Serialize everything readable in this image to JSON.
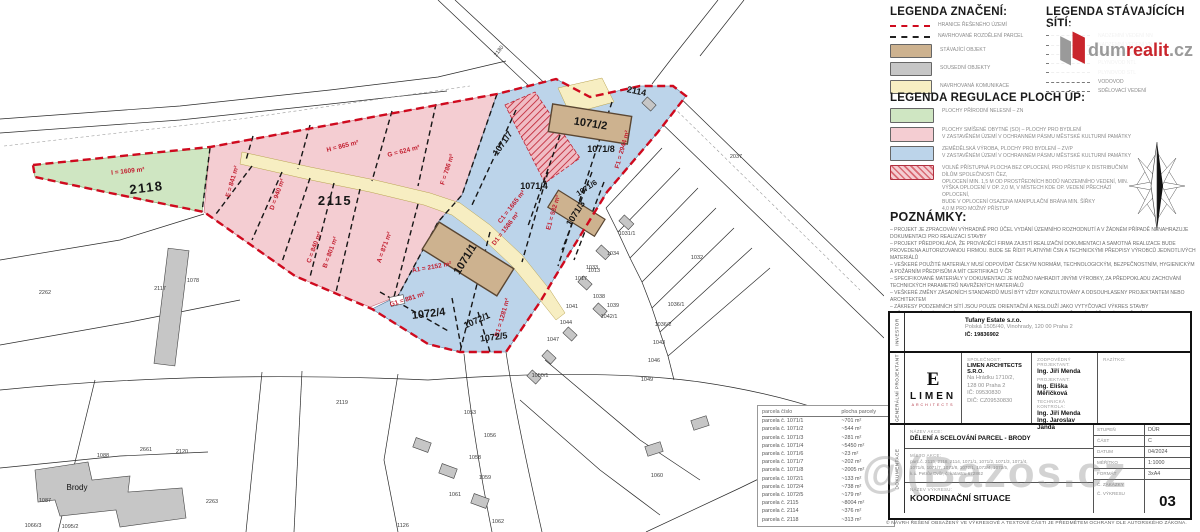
{
  "legend_znaceni": {
    "title": "LEGENDA ZNAČENÍ:",
    "items": [
      {
        "kind": "line",
        "color": "#cf0a1e",
        "label": "HRANICE ŘEŠENÉHO ÚZEMÍ"
      },
      {
        "kind": "line",
        "color": "#222222",
        "label": "NAVRHOVANÉ ROZDĚLENÍ PARCEL"
      },
      {
        "kind": "swatch",
        "color": "#cdb28f",
        "label": "STÁVAJÍCÍ OBJEKT"
      },
      {
        "kind": "swatch",
        "color": "#c6c6c6",
        "label": "SOUSEDNÍ OBJEKTY"
      },
      {
        "kind": "swatch",
        "color": "#f7eec2",
        "label": "NAVRHOVANÁ KOMUNIKACE"
      }
    ]
  },
  "legend_site": {
    "title": "LEGENDA STÁVAJÍCÍCH SÍTÍ:",
    "items": [
      "NADZEMNÍ VEDENÍ NN",
      "NADZEMNÍ VEDENÍ VN",
      "SPLAŠKOVÁ KANALIZACE",
      "PLYNOVOD NTL",
      "PLYNOVOD STL",
      "VODOVOD",
      "SDĚLOVACÍ VEDENÍ"
    ]
  },
  "legend_regulace": {
    "title": "LEGENDA REGULACE PLOCH ÚP:",
    "items": [
      {
        "kind": "swatch",
        "color": "#cfe6c2",
        "label": "PLOCHY PŘÍRODNÍ NELESNÍ – ZN"
      },
      {
        "kind": "swatch",
        "color": "#f4cdd2",
        "label": "PLOCHY SMÍŠENÉ OBYTNÉ (SO) – PLOCHY PRO BYDLENÍ\nV ZASTAVĚNÉM ÚZEMÍ V OCHRANNÉM PÁSMU MĚSTSKÉ KULTURNÍ PAMÁTKY"
      },
      {
        "kind": "swatch",
        "color": "#bcd4ea",
        "label": "ZEMĚDĚLSKÁ VÝROBA, PLOCHY PRO BYDLENÍ – ZV/P\nV ZASTAVĚNÉM ÚZEMÍ V OCHRANNÉM PÁSMU MĚSTSKÉ KULTURNÍ PAMÁTKY"
      },
      {
        "kind": "hatch",
        "color": "#f4cdd2",
        "label": "VOLNĚ PŘÍSTUPNÁ PLOCHA BEZ OPLOCENÍ, PRO PŘÍSTUP K DISTRIBUČNÍM\nDÍLŮM SPOLEČNOSTI ČEZ,\nOPLOCENÍ MIN. 1,5 m OD PROSTŘEDNÍCH BODŮ NADZEMNÍHO VEDENÍ, MIN.\nVÝŠKA OPLOCENÍ V OP. 2,0 m, V MÍSTECH KDE OP. VEDENÍ PŘECHÁZÍ OPLOCENÍ,\nBUDE V OPLOCENÍ OSAZENA MANIPULAČNÍ BRÁNA MIN. ŠÍŘKY\n4,0 m PRO MOŽNÝ PŘÍSTUP"
      }
    ]
  },
  "poznamky": {
    "title": "POZNÁMKY:",
    "lines": [
      "PROJEKT JE ZPRACOVÁN VÝHRADNĚ PRO ÚČEL VYDÁNÍ ÚZEMNÍHO ROZHODNUTÍ A V ŽÁDNÉM PŘÍPADĚ NENAHRAZUJE DOKUMENTACI PRO REALIZACI STAVBY",
      "PROJEKT PŘEDPOKLÁDÁ, ŽE PROVÁDĚCÍ FIRMA ZAJISTÍ REALIZAČNÍ DOKUMENTACI A SAMOTNÁ REALIZACE BUDE PROVEDENA AUTORIZOVANOU FIRMOU. BUDE SE ŘÍDIT PLATNÝMI ČSN A TECHNICKÝMI PŘEDPISY VÝROBCŮ JEDNOTLIVÝCH MATERIÁLŮ",
      "VEŠKERÉ POUŽITÉ MATERIÁLY MUSÍ ODPOVÍDAT ČESKÝM NORMÁM, TECHNOLOGICKÝM, BEZPEČNOSTNÍM, HYGIENICKÝM A POŽÁRNÍM PŘEDPISŮM A MÍT CERTIFIKACI V ČR",
      "SPECIFIKOVANÉ MATERIÁLY V DOKUMENTACI JE MOŽNO NAHRADIT JINÝMI VÝROBKY, ZA PŘEDPOKLADU ZACHOVÁNÍ TECHNICKÝCH PARAMETRŮ NAVRŽENÝCH MATERIÁLŮ",
      "VEŠKERÉ ZMĚNY ZÁSADNÍCH STANDARDŮ MUSÍ BÝT VŽDY KONZULTOVÁNY A ODSOUHLASENY PROJEKTANTEM NEBO ARCHITEKTEM",
      "ZÁKRESY PODZEMNÍCH SÍTÍ JSOU POUZE ORIENTAČNÍ A NESLOUŽÍ JAKO VYTYČOVACÍ VÝKRES STAVBY",
      "PŘED ZAHÁJENÍM ZEMNÍCH PRACÍ PROVEDOU SPRÁVCI SÍTÍ JEJICH SMĚROVÉ I VÝŠKOVÉ VYTYČENÍ",
      "BUDE DODRŽENA ČSN 73 6005 PROSTOROVÉ USPOŘÁDÁNÍ SÍTÍ TECH. VYBAVENÍ",
      "BUDOU DODRŽENY PODMÍNKY VŠECH SPRÁVCŮ SÍTÍ VIZ DOKLADOVÁ ČÁST PD"
    ]
  },
  "parcel_table": {
    "headers": [
      "parcela číslo",
      "plocha parcely"
    ],
    "rows": [
      [
        "parcela č. 1071/1",
        "~701 m²"
      ],
      [
        "parcela č. 1071/2",
        "~544 m²"
      ],
      [
        "parcela č. 1071/3",
        "~281 m²"
      ],
      [
        "parcela č. 1071/4",
        "~5450 m²"
      ],
      [
        "parcela č. 1071/6",
        "~23 m²"
      ],
      [
        "parcela č. 1071/7",
        "~202 m²"
      ],
      [
        "parcela č. 1071/8",
        "~2005 m²"
      ],
      [
        "parcela č. 1072/1",
        "~133 m²"
      ],
      [
        "parcela č. 1072/4",
        "~738 m²"
      ],
      [
        "parcela č. 1072/5",
        "~179 m²"
      ],
      [
        "parcela č. 2115",
        "~8004 m²"
      ],
      [
        "parcela č. 2114",
        "~376 m²"
      ],
      [
        "parcela č. 2118",
        "~313 m²"
      ]
    ]
  },
  "titleblock": {
    "investor": {
      "side_label": "INVESTOR",
      "name": "Tufany Estate s.r.o.",
      "address": "Polská 1505/40, Vinohrady, 120 00 Praha 2",
      "ic": "IČ: 19836902"
    },
    "projektant": {
      "side_label": "GENERÁLNÍ PROJEKTANT",
      "logo_mark": "E",
      "logo_text": "LIMEN",
      "logo_sub": "ARCHITECTS",
      "spolecnost_label": "SPOLEČNOST:",
      "company": "LIMEN ARCHITECTS S.R.O.",
      "address1": "Na Hrádku 1710/2,",
      "address2": "128 00 Praha 2",
      "ic": "IČ: 09530830",
      "dic": "DIČ: CZ09530830",
      "zodp_label": "ZODPOVĚDNÝ PROJEKTANT:",
      "zodp": "Ing. Jiří Menda",
      "proj_label": "PROJEKTANT:",
      "proj": "Ing. Eliška Měřičková",
      "tech_label": "TECHNICKÁ KONTROLA:",
      "tech1": "Ing. Jiří Menda",
      "tech2": "Ing. Jaroslav Janda",
      "razitko_label": "RAZÍTKO:"
    },
    "dokumentace": {
      "side_label": "DOKUMENTACE",
      "nazev_akce_label": "NÁZEV AKCE:",
      "nazev_akce": "DĚLENÍ A SCELOVÁNÍ PARCEL - BRODY",
      "misto_label": "MÍSTO AKCE:",
      "misto_lines": [
        "parc.č. 2115, 2118, 2114, 1071/1, 1071/2, 1071/3, 1071/4,",
        "1071/6, 1071/7, 1071/8, 1072/1, 1072/4, 1072/5,",
        "k.ú. Petrův Dvůr, č. katastru 672862"
      ],
      "nazev_vykresu_label": "NÁZEV VÝKRESU:",
      "nazev_vykresu": "KOORDINAČNÍ SITUACE",
      "meta_rows": [
        {
          "label": "STUPEŇ",
          "value": "DÚR"
        },
        {
          "label": "ČÁST",
          "value": "C"
        },
        {
          "label": "DATUM",
          "value": "04/2024"
        },
        {
          "label": "MĚŘÍTKO",
          "value": "1:1000"
        },
        {
          "label": "FORMÁT",
          "value": "3xA4"
        },
        {
          "label": "Č. ZAKÁZKY",
          "value": ""
        }
      ],
      "vykres_label": "Č. VÝKRESU",
      "vykres_no": "03"
    }
  },
  "copyright": "© NÁVRH ŘEŠENÍ OBSAŽENÝ VE VÝKRESOVÉ A TEXTOVÉ ČÁSTI JE PŘEDMĚTEM OCHRANY DLE AUTORSKÉHO ZÁKONA.",
  "watermarks": {
    "dumrealit_gray1": "dum",
    "dumrealit_red": "realit",
    "dumrealit_gray2": ".cz",
    "bazos": "@(Bazos.cz"
  },
  "map": {
    "colors": {
      "boundary_red": "#cf0a1e",
      "pink": "#f4cdd2",
      "blue": "#bcd4ea",
      "green": "#cfe6c2",
      "road_yellow": "#f7eec2",
      "building_tan": "#cdb28f",
      "building_gray": "#c6c6c6"
    },
    "area_labels": [
      {
        "t": "I = 1609 m²",
        "x": 128,
        "y": 173,
        "r": -6
      },
      {
        "t": "H = 865 m²",
        "x": 343,
        "y": 148,
        "r": -14
      },
      {
        "t": "G = 624 m²",
        "x": 404,
        "y": 153,
        "r": -14
      },
      {
        "t": "F = 786 m²",
        "x": 449,
        "y": 170,
        "r": -72
      },
      {
        "t": "E = 841 m²",
        "x": 234,
        "y": 182,
        "r": -74
      },
      {
        "t": "D = 940 m²",
        "x": 279,
        "y": 195,
        "r": -70
      },
      {
        "t": "C = 840 m²",
        "x": 316,
        "y": 248,
        "r": -70
      },
      {
        "t": "B = 801 m²",
        "x": 332,
        "y": 253,
        "r": -70
      },
      {
        "t": "A = 871 m²",
        "x": 386,
        "y": 248,
        "r": -70
      },
      {
        "t": "A1 = 2152 m²",
        "x": 432,
        "y": 269,
        "r": -10
      },
      {
        "t": "B1 = 1281 m²",
        "x": 504,
        "y": 318,
        "r": -74
      },
      {
        "t": "C1 = 1665 m²",
        "x": 513,
        "y": 208,
        "r": -52
      },
      {
        "t": "D1 = 1586 m²",
        "x": 507,
        "y": 230,
        "r": -52
      },
      {
        "t": "E1 = 932 m²",
        "x": 555,
        "y": 213,
        "r": -74
      },
      {
        "t": "F1 = 2944 m²",
        "x": 624,
        "y": 150,
        "r": -74
      },
      {
        "t": "G1 = 881 m²",
        "x": 408,
        "y": 301,
        "r": -18
      }
    ],
    "parcel_numbers": [
      {
        "t": "2115",
        "x": 335,
        "y": 205,
        "r": 0,
        "cls": "numxl"
      },
      {
        "t": "2118",
        "x": 147,
        "y": 192,
        "r": -7,
        "cls": "numxl"
      },
      {
        "t": "2114",
        "x": 636,
        "y": 94,
        "r": 12,
        "cls": "num"
      },
      {
        "t": "1071/2",
        "x": 590,
        "y": 127,
        "r": 9,
        "cls": "numl"
      },
      {
        "t": "1071/8",
        "x": 601,
        "y": 152,
        "r": 0,
        "cls": "num"
      },
      {
        "t": "1071/7",
        "x": 505,
        "y": 145,
        "r": -55,
        "cls": "num"
      },
      {
        "t": "1071/4",
        "x": 534,
        "y": 189,
        "r": 0,
        "cls": "num"
      },
      {
        "t": "1071/6",
        "x": 588,
        "y": 190,
        "r": -33,
        "cls": "nums"
      },
      {
        "t": "1071/3",
        "x": 578,
        "y": 215,
        "r": -58,
        "cls": "num"
      },
      {
        "t": "1071/1",
        "x": 468,
        "y": 261,
        "r": -58,
        "cls": "numl"
      },
      {
        "t": "1072/4",
        "x": 429,
        "y": 317,
        "r": -7,
        "cls": "numl"
      },
      {
        "t": "1072/1",
        "x": 478,
        "y": 323,
        "r": -24,
        "cls": "num"
      },
      {
        "t": "1072/5",
        "x": 494,
        "y": 340,
        "r": -7,
        "cls": "num"
      }
    ],
    "neighbor_labels": [
      {
        "t": "2180",
        "x": 500,
        "y": 52,
        "r": -52
      },
      {
        "t": "2037",
        "x": 736,
        "y": 158
      },
      {
        "t": "1032",
        "x": 697,
        "y": 259
      },
      {
        "t": "1031/1",
        "x": 627,
        "y": 235
      },
      {
        "t": "1034",
        "x": 613,
        "y": 255
      },
      {
        "t": "1033",
        "x": 592,
        "y": 269
      },
      {
        "t": "1017",
        "x": 581,
        "y": 280
      },
      {
        "t": "1038",
        "x": 599,
        "y": 298
      },
      {
        "t": "1039",
        "x": 613,
        "y": 307
      },
      {
        "t": "1041",
        "x": 572,
        "y": 308
      },
      {
        "t": "1042/1",
        "x": 609,
        "y": 318
      },
      {
        "t": "1044",
        "x": 566,
        "y": 324
      },
      {
        "t": "1036/1",
        "x": 676,
        "y": 306
      },
      {
        "t": "1036/2",
        "x": 663,
        "y": 326
      },
      {
        "t": "1043",
        "x": 659,
        "y": 344
      },
      {
        "t": "1046",
        "x": 654,
        "y": 362
      },
      {
        "t": "1049",
        "x": 647,
        "y": 381
      },
      {
        "t": "1047",
        "x": 553,
        "y": 341
      },
      {
        "t": "1050/1",
        "x": 540,
        "y": 377
      },
      {
        "t": "1013",
        "x": 594,
        "y": 272
      },
      {
        "t": "1053",
        "x": 470,
        "y": 414
      },
      {
        "t": "1060",
        "x": 657,
        "y": 477
      },
      {
        "t": "2117",
        "x": 160,
        "y": 290
      },
      {
        "t": "2262",
        "x": 45,
        "y": 294
      },
      {
        "t": "1078",
        "x": 193,
        "y": 282
      },
      {
        "t": "2119",
        "x": 342,
        "y": 404
      },
      {
        "t": "1088",
        "x": 103,
        "y": 457
      },
      {
        "t": "2661",
        "x": 146,
        "y": 451
      },
      {
        "t": "2120",
        "x": 182,
        "y": 453
      },
      {
        "t": "2263",
        "x": 212,
        "y": 503
      },
      {
        "t": "1087",
        "x": 45,
        "y": 502
      },
      {
        "t": "1066/3",
        "x": 33,
        "y": 527
      },
      {
        "t": "1095/2",
        "x": 70,
        "y": 528
      },
      {
        "t": "1056",
        "x": 490,
        "y": 437
      },
      {
        "t": "1058",
        "x": 475,
        "y": 459
      },
      {
        "t": "1059",
        "x": 485,
        "y": 479
      },
      {
        "t": "1061",
        "x": 455,
        "y": 496
      },
      {
        "t": "1126",
        "x": 403,
        "y": 527
      },
      {
        "t": "1062",
        "x": 498,
        "y": 523
      },
      {
        "t": "Brody",
        "x": 77,
        "y": 490,
        "cls": "town"
      }
    ]
  }
}
